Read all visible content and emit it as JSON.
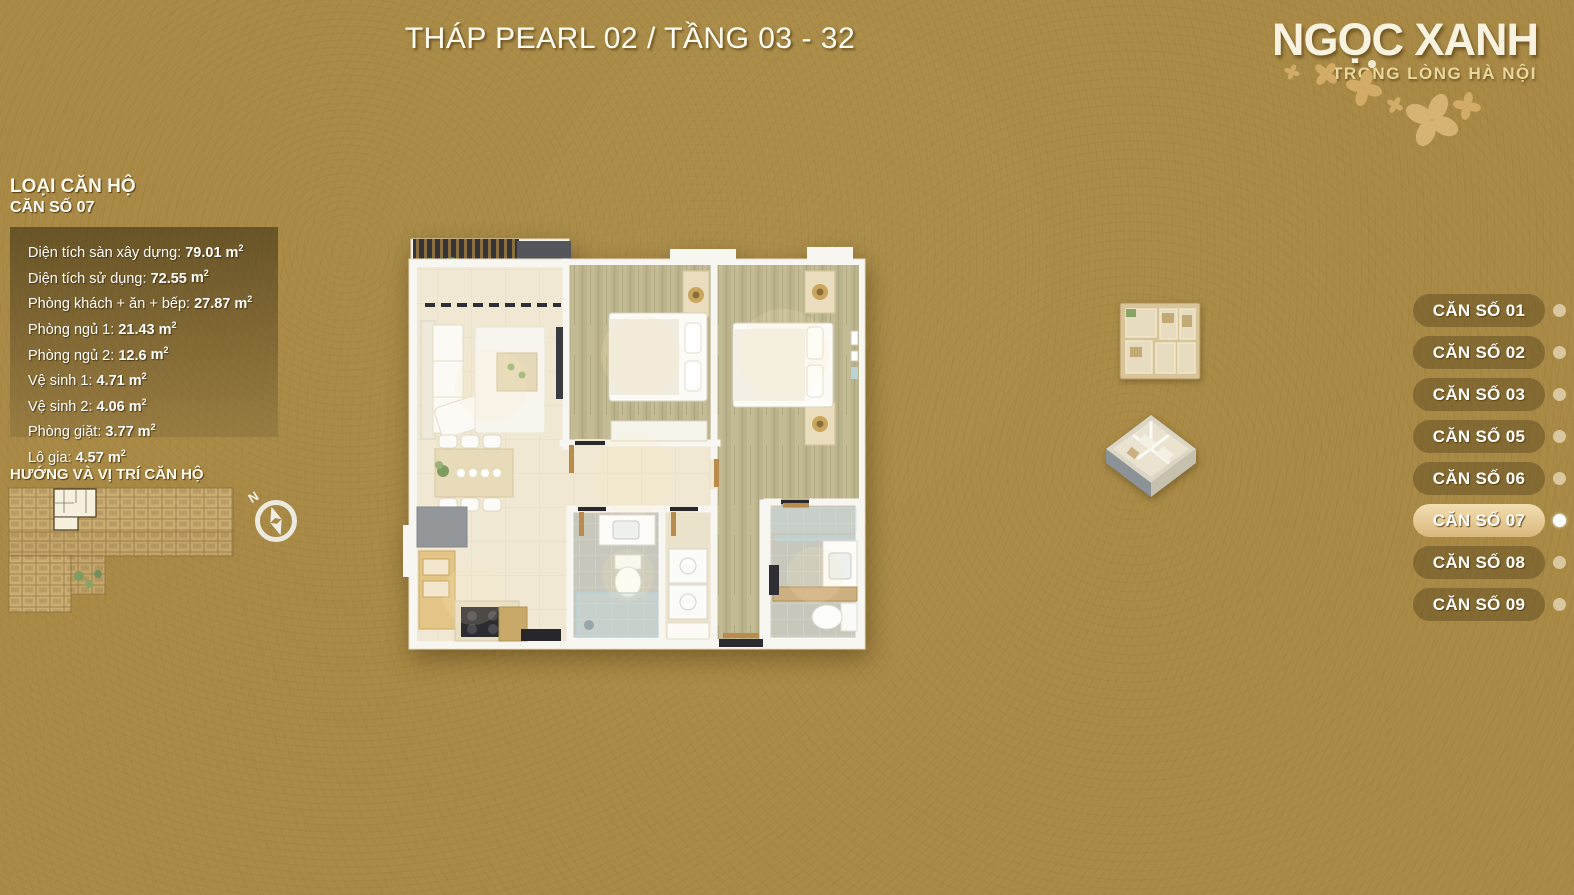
{
  "title": "THÁP PEARL 02 / TẦNG 03 - 32",
  "logo": {
    "name": "NGỌC XANH",
    "tagline": "TRONG LÒNG HÀ NỘI"
  },
  "unit_info": {
    "heading": "LOẠI CĂN HỘ",
    "unit_name": "CĂN SỐ 07",
    "area_unit_base": "m",
    "area_unit_exp": "2",
    "specs": [
      {
        "label": "Diện tích sàn xây dựng:",
        "value": "79.01"
      },
      {
        "label": "Diện tích sử dụng:",
        "value": "72.55"
      },
      {
        "label": "Phòng khách + ăn + bếp:",
        "value": "27.87"
      },
      {
        "label": "Phòng ngủ 1:",
        "value": "21.43"
      },
      {
        "label": "Phòng ngủ 2:",
        "value": "12.6"
      },
      {
        "label": "Vệ sinh 1:",
        "value": "4.71"
      },
      {
        "label": "Vệ sinh 2:",
        "value": "4.06"
      },
      {
        "label": "Phòng giặt:",
        "value": "3.77"
      },
      {
        "label": "Lô gia:",
        "value": "4.57"
      }
    ]
  },
  "location_section": {
    "heading": "HƯỚNG VÀ VỊ TRÍ CĂN HỘ",
    "compass_label": "N"
  },
  "unit_selector": [
    {
      "label": "CĂN SỐ 01",
      "active": false
    },
    {
      "label": "CĂN SỐ 02",
      "active": false
    },
    {
      "label": "CĂN SỐ 03",
      "active": false
    },
    {
      "label": "CĂN SỐ 05",
      "active": false
    },
    {
      "label": "CĂN SỐ 06",
      "active": false
    },
    {
      "label": "CĂN SỐ 07",
      "active": true
    },
    {
      "label": "CĂN SỐ 08",
      "active": false
    },
    {
      "label": "CĂN SỐ 09",
      "active": false
    }
  ],
  "icons": {
    "compass": "compass-rose-icon",
    "flowers": "flower-petal-decoration"
  },
  "colors": {
    "background": "#a98a46",
    "panel": "rgba(52,40,14,0.55)",
    "button_inactive": "rgba(56,42,12,0.32)",
    "button_active": "#e3c78d",
    "dot": "#d9c7a0",
    "dot_active": "#ffffff",
    "text": "#ffffff",
    "tagline": "#e9d79e"
  }
}
